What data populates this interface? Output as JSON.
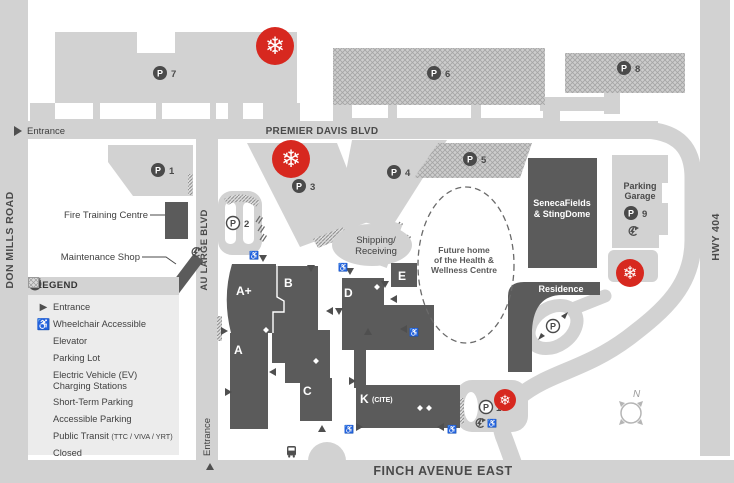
{
  "colors": {
    "road": "#d2d2d2",
    "building": "#5b5b5b",
    "closed_red": "#d7281f",
    "text": "#4a4a4a"
  },
  "roads": {
    "don_mills": "DON MILLS ROAD",
    "premier_davis": "PREMIER DAVIS BLVD",
    "au_large": "AU LARGE BLVD",
    "finch": "FINCH AVENUE EAST",
    "hwy404": "HWY 404"
  },
  "entrances": {
    "west_label": "Entrance",
    "south_label": "Entrance"
  },
  "landmarks": {
    "fire_training": "Fire Training Centre",
    "maintenance": "Maintenance Shop",
    "shipping_line1": "Shipping/",
    "shipping_line2": "Receiving",
    "seneca_line1": "SenecaFields",
    "seneca_line2": "& StingDome",
    "residence": "Residence",
    "garage_line1": "Parking",
    "garage_line2": "Garage",
    "future_line1": "Future home",
    "future_line2": "of the Health &",
    "future_line3": "Wellness Centre"
  },
  "buildings": {
    "a_plus": "A+",
    "b": "B",
    "a": "A",
    "c": "C",
    "d": "D",
    "e": "E",
    "k": "K",
    "k_suffix": "(CITE)"
  },
  "parking": {
    "symbol": "P",
    "p1": "1",
    "p2": "2",
    "p3": "3",
    "p4": "4",
    "p5": "5",
    "p6": "6",
    "p7": "7",
    "p8": "8",
    "p9": "9",
    "p10": "10"
  },
  "legend": {
    "title": "LEGEND",
    "items": {
      "entrance": "Entrance",
      "wheelchair": "Wheelchair Accessible",
      "elevator": "Elevator",
      "parking_lot": "Parking Lot",
      "ev_line1": "Electric Vehicle (EV)",
      "ev_line2": "Charging Stations",
      "short_term": "Short-Term Parking",
      "accessible": "Accessible Parking",
      "transit": "Public Transit",
      "transit_suffix": "(TTC / VIVA / YRT)",
      "closed": "Closed"
    }
  },
  "compass": {
    "north": "N"
  },
  "icons": {
    "snowflake": "❄",
    "entrance_triangle": "▶",
    "wheelchair": "♿",
    "up_triangle": "▲"
  }
}
